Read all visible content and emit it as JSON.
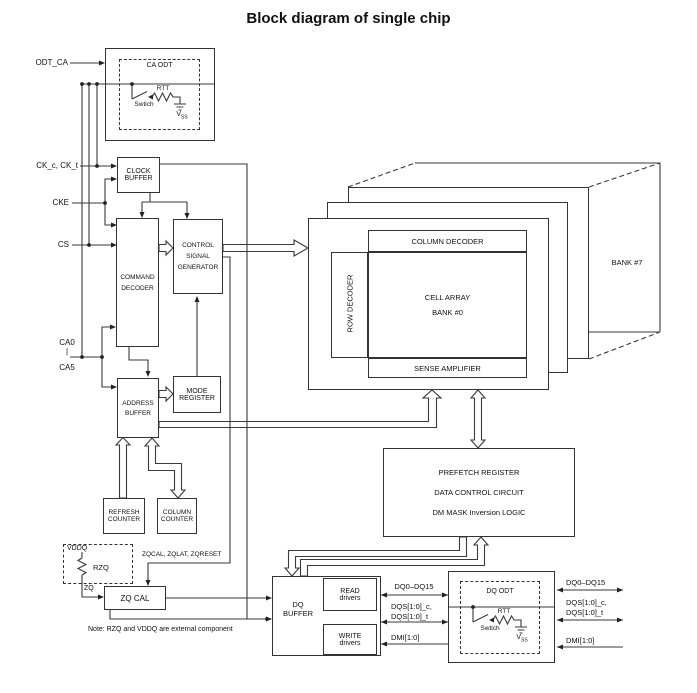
{
  "title": "Block diagram of single chip",
  "pins": {
    "odt_ca": "ODT_CA",
    "ck": "CK_c, CK_t",
    "cke": "CKE",
    "cs": "CS",
    "ca0": "CA0",
    "ca_bar": "|",
    "ca5": "CA5"
  },
  "ca_odt": {
    "title": "CA ODT",
    "rtt": "RTT",
    "switch_label": "Swtich",
    "vss_base": "V",
    "vss_sub": "SS"
  },
  "dq_odt": {
    "title": "DQ ODT",
    "rtt": "RTT",
    "switch_label": "Swtich",
    "vss_base": "V",
    "vss_sub": "SS"
  },
  "blocks": {
    "clock_buffer": [
      "CLOCK",
      "BUFFER"
    ],
    "command_decoder": [
      "COMMAND",
      "DECODER"
    ],
    "control_signal_generator": [
      "CONTROL",
      "SIGNAL",
      "GENERATOR"
    ],
    "mode_register": [
      "MODE",
      "REGISTER"
    ],
    "address_buffer": [
      "ADDRESS",
      "BUFFER"
    ],
    "refresh_counter": [
      "REFRESH",
      "COUNTER"
    ],
    "column_counter": [
      "COLUMN",
      "COUNTER"
    ],
    "zq_cal": "ZQ CAL",
    "dq_buffer": [
      "DQ",
      "BUFFER"
    ],
    "read_drivers": [
      "READ",
      "drivers"
    ],
    "write_drivers": [
      "WRITE",
      "drivers"
    ],
    "prefetch": [
      "PREFETCH REGISTER",
      "DATA CONTROL CIRCUIT",
      "DM MASK Inversion LOGIC"
    ]
  },
  "bank": {
    "column_decoder": "COLUMN DECODER",
    "row_decoder": "ROW DECODER",
    "cell_array_1": "CELL ARRAY",
    "cell_array_2": "BANK #0",
    "sense_amplifier": "SENSE AMPLIFIER",
    "bank7": "BANK #7"
  },
  "zq": {
    "vddq": "VDDQ",
    "rzq": "RZQ",
    "zq": "ZQ",
    "command": "ZQCAL, ZQLAT, ZQRESET"
  },
  "io": {
    "dq_inner": "DQ0–DQ15",
    "dqs_inner_1": "DQS[1:0]_c,",
    "dqs_inner_2": "DQS[1:0]_t",
    "dmi_inner": "DMI[1:0]",
    "dq_outer": "DQ0–DQ15",
    "dqs_outer_1": "DQS[1:0]_c,",
    "dqs_outer_2": "DQS[1:0]_t",
    "dmi_outer": "DMI[1:0]"
  },
  "note": "Note: RZQ and VDDQ are external component"
}
